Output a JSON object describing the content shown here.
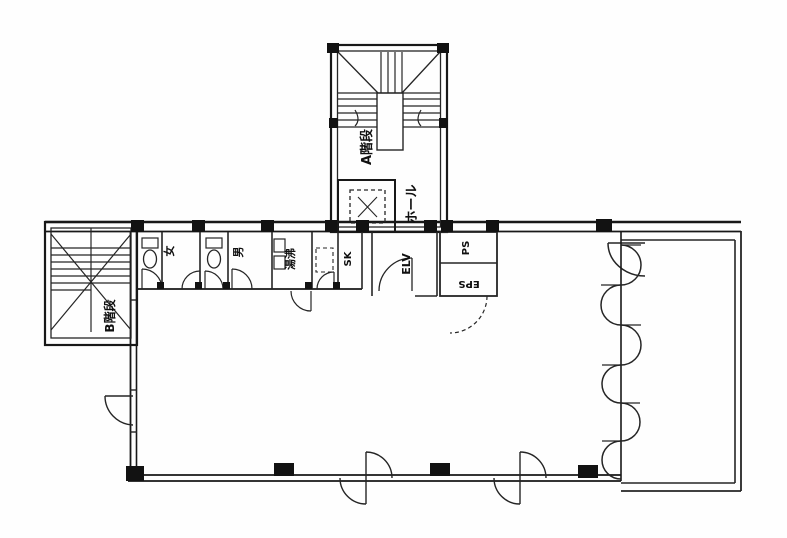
{
  "page": {
    "background": "#fefefe",
    "ink": "#1e1e1e",
    "description": "Scanned building floor plan"
  },
  "floorplan": {
    "labels": {
      "stair_a": "A階段",
      "hall": "ホール",
      "elevator": "ELV",
      "pipe_shaft": "PS",
      "electric_pipe_shaft": "EPS",
      "wc_women": "女",
      "wc_men": "男",
      "kitchenette": "湯沸",
      "slop_sink": "SK",
      "stair_b": "B階段"
    }
  }
}
